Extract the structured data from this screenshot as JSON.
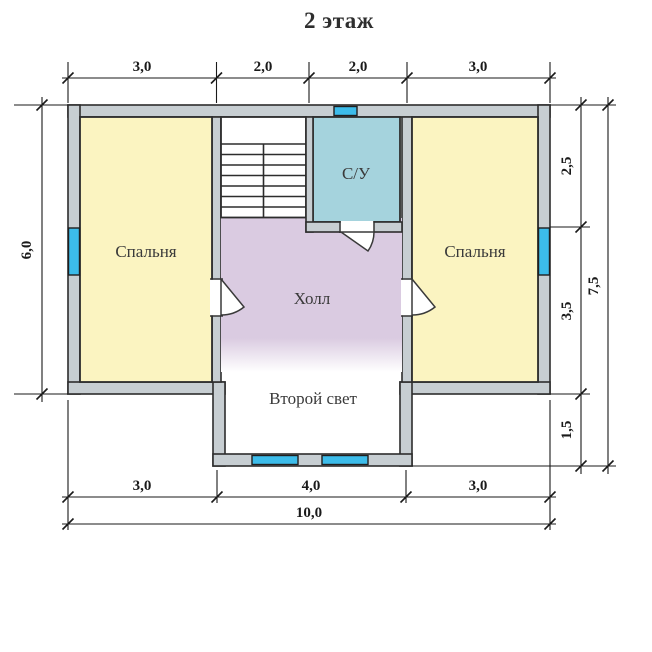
{
  "title": "2 этаж",
  "rooms": {
    "bedroom_left": {
      "label": "Спальня",
      "color": "#FBF4C1"
    },
    "bedroom_right": {
      "label": "Спальня",
      "color": "#FBF4C1"
    },
    "hall": {
      "label": "Холл",
      "color": "#DACBE1"
    },
    "bathroom": {
      "label": "С/У",
      "color": "#A5D3DD"
    },
    "void": {
      "label": "Второй свет",
      "color": "#FFFFFF"
    }
  },
  "dimensions": {
    "top": [
      "3,0",
      "2,0",
      "2,0",
      "3,0"
    ],
    "left": "6,0",
    "right": [
      "2,5",
      "3,5",
      "1,5"
    ],
    "right_total": "7,5",
    "bottom": [
      "3,0",
      "4,0",
      "3,0"
    ],
    "bottom_total": "10,0"
  },
  "colors": {
    "wall_fill": "#C7CED2",
    "outline": "#2D2D2D",
    "window": "#3CBCEA",
    "dimension_lines": "#1A1A1A",
    "label_text": "#3A3A3A"
  }
}
